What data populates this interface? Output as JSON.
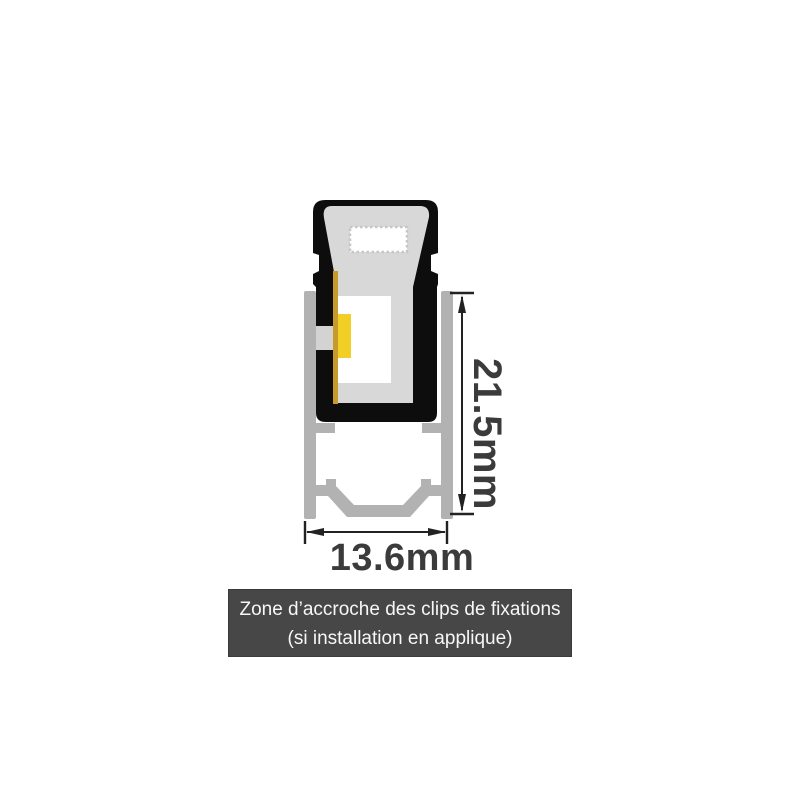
{
  "diagram": {
    "dimensions": {
      "height_label": "21.5mm",
      "width_label": "13.6mm"
    },
    "caption": {
      "line1": "Zone d’accroche des clips de fixations",
      "line2": "(si installation en applique)"
    },
    "colors": {
      "background": "#ffffff",
      "silicone_body": "#0d0d0d",
      "diffuser_gray": "#d8d8d8",
      "notch_gray": "#d3d3d3",
      "cavity_white": "#ffffff",
      "serration_stroke": "#c6c6c6",
      "pcb_gold": "#c79b2b",
      "led_yellow": "#f2cf25",
      "aluminium": "#b2b2b2",
      "dimension_line": "#222222",
      "dimension_text": "#3b3b3b",
      "caption_bg": "#474747",
      "caption_text": "#f7f7f7"
    }
  }
}
